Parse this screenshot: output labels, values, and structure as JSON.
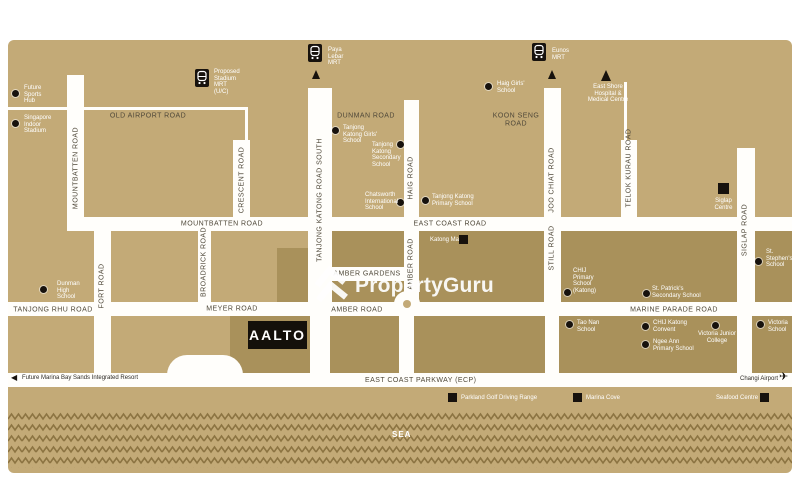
{
  "watermark": {
    "brand": "PropertyGuru"
  },
  "property": {
    "name": "AALTO"
  },
  "sea_label": "SEA",
  "colors": {
    "land": "#c3aa77",
    "district_block": "#a9915b",
    "road": "#fffefb",
    "wave": "#8c7442",
    "marker_dark": "#17120d",
    "poi_text": "#ffffff",
    "road_text": "#4f4839"
  },
  "roads": {
    "old_airport": "OLD AIRPORT ROAD",
    "dunman": "DUNMAN ROAD",
    "koon_seng": "KOON SENG\nROAD",
    "mountbatten_vertical": "MOUNTBATTEN ROAD",
    "crescent": "CRESCENT ROAD",
    "fort": "FORT ROAD",
    "broadrick": "BROADRICK ROAD",
    "tanjong_katong_south": "TANJONG KATONG ROAD SOUTH",
    "haig": "HAIG ROAD",
    "amber_vertical": "AMBER ROAD",
    "joo_chiat": "JOO CHIAT ROAD",
    "still": "STILL ROAD",
    "telok_kurau": "TELOK KURAU ROAD",
    "siglap": "SIGLAP ROAD",
    "mountbatten": "MOUNTBATTEN ROAD",
    "east_coast": "EAST COAST ROAD",
    "tanjong_rhu": "TANJONG RHU ROAD",
    "meyer": "MEYER ROAD",
    "amber": "AMBER ROAD",
    "amber_gardens": "AMBER GARDENS",
    "marine_parade": "MARINE PARADE ROAD",
    "east_coast_parkway": "EAST COAST PARKWAY (ECP)"
  },
  "mrt": {
    "proposed_stadium": "Proposed\nStadium\nMRT\n(U/C)",
    "paya_lebar": "Paya\nLebar\nMRT",
    "eunos": "Eunos\nMRT"
  },
  "places": {
    "future_sports_hub": "Future\nSports\nHub",
    "singapore_indoor_stadium": "Singapore\nIndoor\nStadium",
    "east_shore_hospital": "East Shore\nHospital &\nMedical Centre",
    "haig_girls": "Haig Girls'\nSchool",
    "tanjong_katong_girls": "Tanjong\nKatong Girls'\nSchool",
    "tanjong_katong_secondary": "Tanjong\nKatong\nSecondary\nSchool",
    "chatsworth": "Chatsworth\nInternational\nSchool",
    "tanjong_katong_primary": "Tanjong Katong\nPrimary School",
    "katong_mall": "Katong Mall",
    "chij_primary_katong": "CHIJ\nPrimary\nSchool\n(Katong)",
    "st_patricks": "St. Patrick's\nSecondary School",
    "siglap_centre": "Siglap\nCentre",
    "st_stephens": "St.\nStephen's\nSchool",
    "dunman_high": "Dunman\nHigh\nSchool",
    "tao_nan": "Tao Nan\nSchool",
    "chij_katong_convent": "CHIJ Katong\nConvent",
    "ngee_ann_primary": "Ngee Ann\nPrimary School",
    "victoria_junior_college": "Victoria Junior\nCollege",
    "victoria_school": "Victoria\nSchool",
    "parkland_golf": "Parkland Golf Driving Range",
    "marina_cove": "Marina Cove",
    "seafood_centre": "Seafood Centre"
  },
  "directions": {
    "future_mbs": "Future Marina Bay Sands Integrated Resort",
    "changi_airport": "Changi Airport"
  }
}
